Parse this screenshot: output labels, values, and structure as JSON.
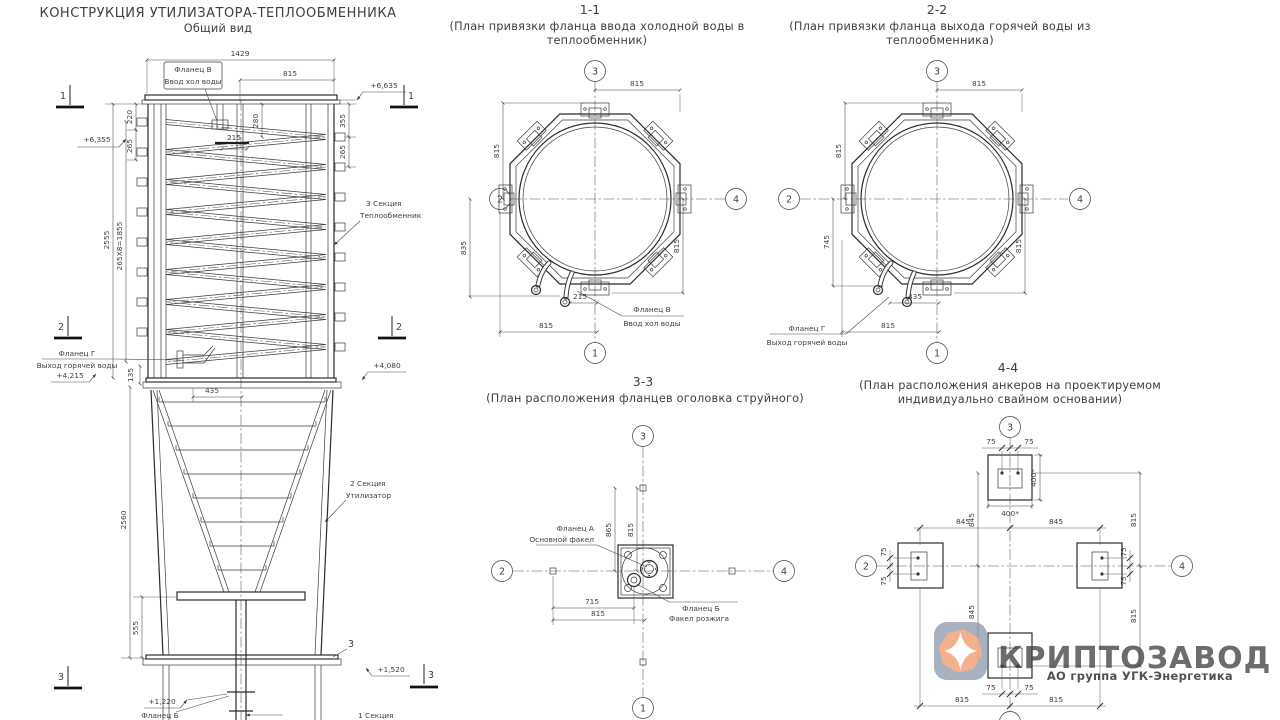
{
  "drawing": {
    "title": "КОНСТРУКЦИЯ УТИЛИЗАТОРА-ТЕПЛООБМЕННИКА",
    "subtitle": "Общий вид"
  },
  "gv": {
    "flange_v": "Фланец В",
    "flange_v_desc": "Ввод хол воды",
    "flange_g": "Фланец Г",
    "flange_g_desc": "Выход горячей воды",
    "flange_b": "Фланец Б",
    "sec3": "3 Секция",
    "sec3_desc": "Теплообмен​ник",
    "sec2": "2 Секция",
    "sec2_desc": "Утилизатор",
    "sec1": "1 Секция",
    "elev_6635": "+6,635",
    "elev_6355": "+6,355",
    "elev_4215": "+4,215",
    "elev_4080": "+4,080",
    "elev_1520": "+1,520",
    "elev_1220": "+1,220",
    "dim_1429": "1429",
    "dim_815": "815",
    "dim_220": "220",
    "dim_265": "265",
    "dim_280": "280",
    "dim_215": "215",
    "dim_355": "355",
    "dim_2555": "2555",
    "dim_1855": "265X8=1855",
    "dim_135": "135",
    "dim_435": "435",
    "dim_2560": "2560",
    "dim_555": "555",
    "m1": "1",
    "m2": "2",
    "m3": "3"
  },
  "s11": {
    "title": "1-1",
    "sub1": "(План привязки фланца ввода холодной воды в",
    "sub2": "теплообменник)",
    "d_top": "815",
    "d_lu": "815",
    "d_ll": "835",
    "d_rl": "815",
    "d_off": "215",
    "d_bot": "815",
    "flange": "Фланец В",
    "flange_desc": "Ввод хол воды",
    "b_top": "3",
    "b_left": "2",
    "b_right": "4",
    "b_bot": "1"
  },
  "s22": {
    "title": "2-2",
    "sub1": "(План привязки фланца выхода горячей воды из",
    "sub2": "теплообменника)",
    "d_top": "815",
    "d_lu": "815",
    "d_ll": "745",
    "d_rl": "815",
    "d_off": "435",
    "d_bot": "815",
    "flange": "Фланец Г",
    "flange_desc": "Выход горячей воды",
    "b_top": "3",
    "b_left": "2",
    "b_right": "4",
    "b_bot": "1"
  },
  "s33": {
    "title": "3-3",
    "sub1": "(План расположения фланцев оголовка струйного)",
    "d_865": "865",
    "d_815v": "815",
    "d_715": "715",
    "d_815h": "815",
    "flange_a": "Фланец А",
    "flange_a_desc": "Основной факел",
    "flange_b": "Фланец Б",
    "flange_b_desc": "Факел розжига",
    "b_top": "3",
    "b_left": "2",
    "b_right": "4",
    "b_bot": "1"
  },
  "s44": {
    "title": "4-4",
    "sub1": "(План расположения анкеров на проектируемом",
    "sub2": "индивидуально свайном основании)",
    "d_75": "75",
    "d_400": "400*",
    "d_845": "845",
    "d_815": "815",
    "b_top": "3",
    "b_left": "2",
    "b_right": "4"
  },
  "logo": {
    "name": "КРИПТОЗАВОД",
    "tagline": "АО группа УГК-Энергетика",
    "colors": {
      "text": "#8795ab",
      "tagline": "#ee8455",
      "badge": "#8492a6",
      "gem": "#f3a881",
      "star": "#ffffff"
    }
  }
}
